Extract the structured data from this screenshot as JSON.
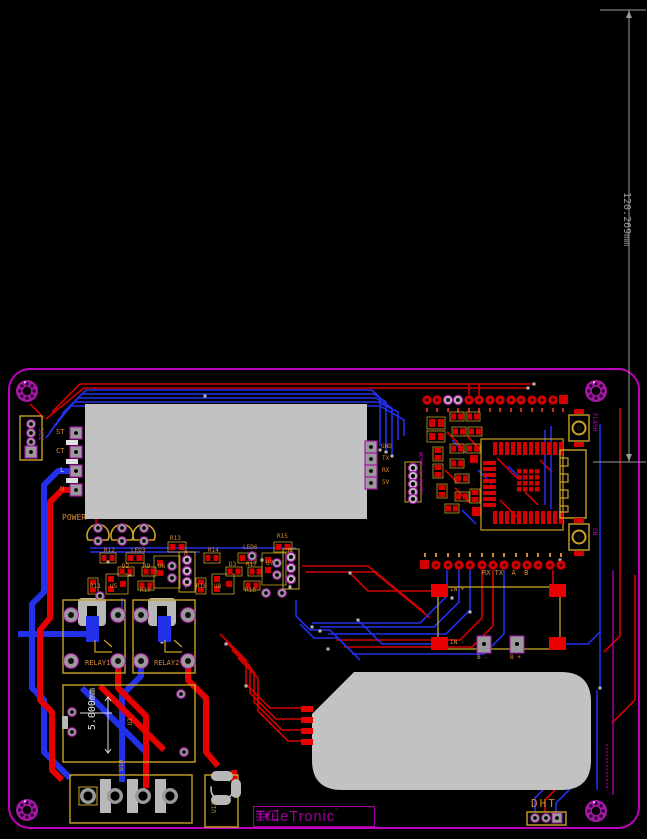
{
  "view": {
    "type": "pcb-layout-canvas",
    "background": "#000000"
  },
  "dimension_annotations": {
    "board_span": "120.269mm",
    "module_span": "5.000mm"
  },
  "silkscreen": {
    "power": "POWER",
    "relay1": "RELAY1",
    "relay2": "RELAY2",
    "dht": "DHT",
    "i2c": "I2C",
    "flash": "FLASH",
    "en": "EN",
    "esp_note": "WEMOS 32 RX/TX",
    "uart_note": "RX TX  A  B",
    "in_plus": "IN +",
    "in_minus": "IN -",
    "b_minus": "B -",
    "b_plus": "B +",
    "pad_st": "ST",
    "pad_ct": "CT",
    "pad_l": "L",
    "pad_n": "N",
    "pad_gnd": "GND",
    "pad_tx": "TX",
    "pad_rx": "RX",
    "pad_5v": "5V",
    "header_h": "H",
    "header_t": "T"
  },
  "refdes": {
    "r9": "R9",
    "r10": "R10",
    "r11": "R11",
    "r12": "R12",
    "r13": "R13",
    "r14": "R14",
    "r15": "R15",
    "r16": "R16",
    "r17": "R17",
    "r18": "R18",
    "d2": "D2",
    "d3": "D3",
    "led3": "LED3",
    "led6": "LED6",
    "u3": "U3",
    "u5": "U5",
    "u6": "U6",
    "u7": "U7",
    "u8": "U8",
    "u10": "U10",
    "u12": "U12"
  },
  "logo": {
    "brand": "TrueTronic",
    "tm": "™"
  },
  "colors": {
    "board_outline": "#bf00bf",
    "copper_top": "#d40000",
    "copper_bottom": "#2230e8",
    "component_outline": "#c9a227",
    "silkscreen_text": "#d98a33",
    "component_body": "#c2c2c2",
    "annotation": "#9a9a9a"
  }
}
